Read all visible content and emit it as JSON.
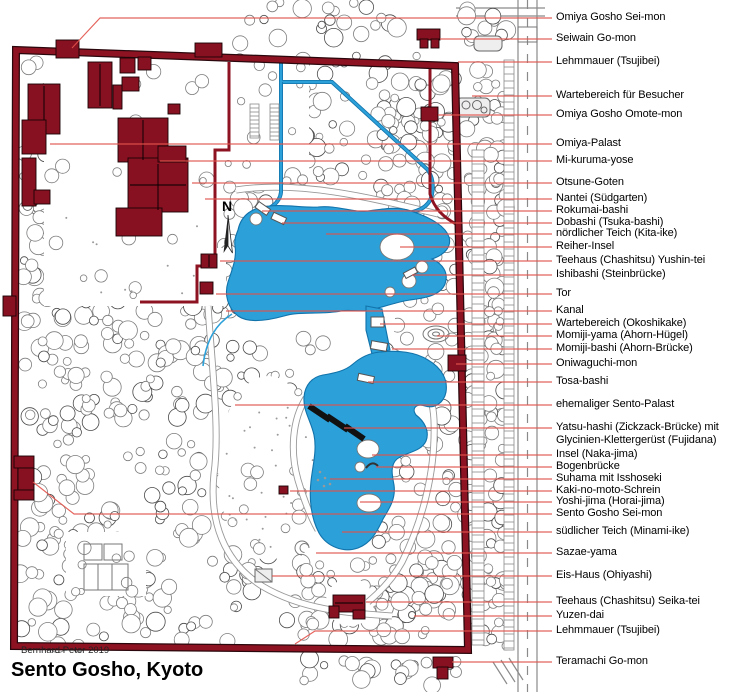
{
  "title": "Sento Gosho, Kyoto",
  "credit": "Bernhard Peter 2019",
  "compass": {
    "label": "N"
  },
  "colors": {
    "wall": "#8e1322",
    "building": "#871120",
    "water": "#2ba0d9",
    "water_dark": "#1272aa",
    "leader": "#e2534b",
    "tree_stroke": "#7d7d7d"
  },
  "labels": [
    {
      "text": "Omiya Gosho Sei-mon",
      "y": 18,
      "pts": [
        [
          72,
          48
        ],
        [
          100,
          18
        ]
      ]
    },
    {
      "text": "Seiwain Go-mon",
      "y": 39,
      "x1": 440
    },
    {
      "text": "Lehmmauer (Tsujibei)",
      "y": 62,
      "x1": 458
    },
    {
      "text": "Wartebereich für Besucher",
      "y": 96,
      "x1": 472
    },
    {
      "text": "Omiya Gosho Omote-mon",
      "y": 115,
      "x1": 438
    },
    {
      "text": "Omiya-Palast",
      "y": 144,
      "x1": 50
    },
    {
      "text": "Mi-kuruma-yose",
      "y": 161,
      "x1": 160
    },
    {
      "text": "Otsune-Goten",
      "y": 183,
      "x1": 192
    },
    {
      "text": "Nantei (Südgarten)",
      "y": 199,
      "x1": 205
    },
    {
      "text": "Rokumai-bashi",
      "y": 211,
      "x1": 262
    },
    {
      "text": "Dobashi (Tsuka-bashi)",
      "y": 223,
      "x1": 282
    },
    {
      "text": "nördlicher Teich (Kita-ike)",
      "y": 234,
      "x1": 326
    },
    {
      "text": "Reiher-Insel",
      "y": 247,
      "x1": 400
    },
    {
      "text": "Teehaus (Chashitsu) Yushin-tei",
      "y": 261,
      "x1": 220
    },
    {
      "text": "Ishibashi (Steinbrücke)",
      "y": 275,
      "x1": 412
    },
    {
      "text": "Tor",
      "y": 294,
      "x1": 216
    },
    {
      "text": "Kanal",
      "y": 311,
      "x1": 226
    },
    {
      "text": "Wartebereich (Okoshikake)",
      "y": 324,
      "x1": 380
    },
    {
      "text": "Momiji-yama (Ahorn-Hügel)",
      "y": 336,
      "x1": 437
    },
    {
      "text": "Momiji-bashi (Ahorn-Brücke)",
      "y": 349,
      "x1": 392
    },
    {
      "text": "Oniwaguchi-mon",
      "y": 364,
      "x1": 456
    },
    {
      "text": "Tosa-bashi",
      "y": 382,
      "x1": 368
    },
    {
      "text": "ehemaliger Sento-Palast",
      "y": 405,
      "x1": 235
    },
    {
      "text": "Yatsu-hashi (Zickzack-Brücke) mit",
      "text2": "Glycinien-Klettergerüst (Fujidana)",
      "y": 428,
      "x1": 344
    },
    {
      "text": "Insel (Naka-jima)",
      "y": 455,
      "x1": 372
    },
    {
      "text": "Bogenbrücke",
      "y": 467,
      "x1": 376
    },
    {
      "text": "Suhama mit Isshoseki",
      "y": 479,
      "x1": 330
    },
    {
      "text": "Kaki-no-moto-Schrein",
      "y": 491,
      "x1": 290
    },
    {
      "text": "Yoshi-jima (Horai-jima)",
      "y": 502,
      "x1": 360
    },
    {
      "text": "Sento Gosho Sei-mon",
      "y": 514,
      "pts": [
        [
          33,
          482
        ],
        [
          74,
          514
        ]
      ]
    },
    {
      "text": "südlicher Teich (Minami-ike)",
      "y": 532,
      "x1": 342
    },
    {
      "text": "Sazae-yama",
      "y": 553,
      "x1": 316
    },
    {
      "text": "Eis-Haus (Ohiyashi)",
      "y": 576,
      "x1": 272
    },
    {
      "text": "Teehaus (Chashitsu) Seika-tei",
      "y": 602,
      "x1": 366
    },
    {
      "text": "Yuzen-dai",
      "y": 616,
      "x1": 414
    },
    {
      "text": "Lehmmauer (Tsujibei)",
      "y": 631,
      "pts": [
        [
          295,
          644
        ],
        [
          315,
          631
        ]
      ]
    },
    {
      "text": "Teramachi Go-mon",
      "y": 662,
      "x1": 452
    }
  ]
}
